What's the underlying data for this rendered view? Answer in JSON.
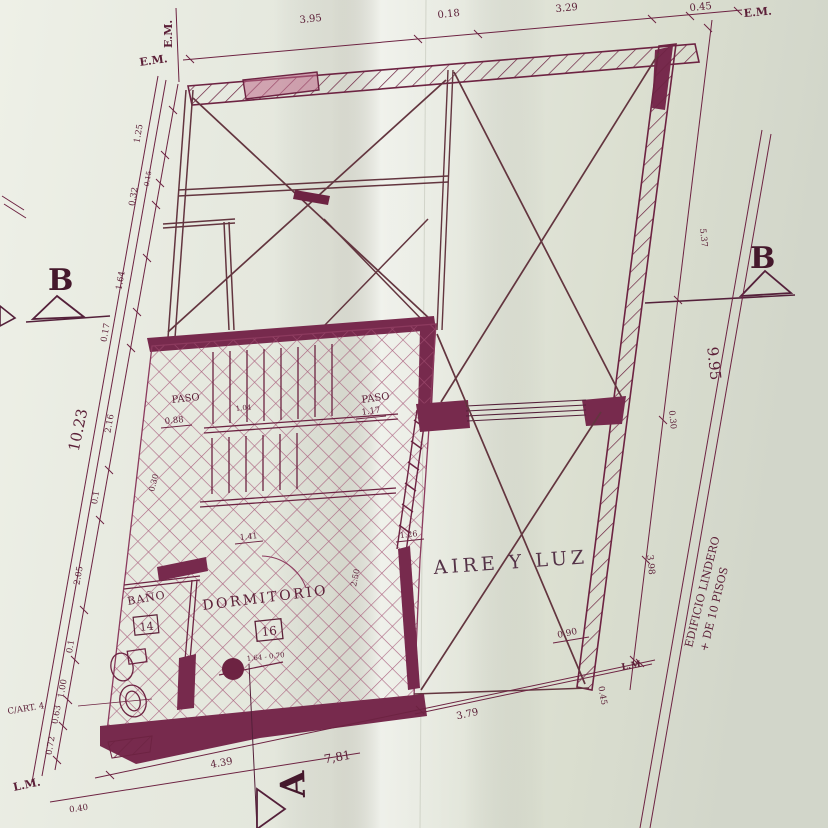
{
  "title": "Planta arquitectónica - plano escaneado",
  "palette": {
    "ink": "#6d2342",
    "ink_dark": "#54203a",
    "ink_light": "#a24f72",
    "wall_fill": "#772a4d",
    "paper": "#e6e9df",
    "paper_dark": "#d7dbd0",
    "text": "#5c2038",
    "accent_pink": "#c06a8a"
  },
  "markers": {
    "section_b_left": "B",
    "section_b_right": "B",
    "section_a": "A"
  },
  "boundary_labels": {
    "em_left_vertical": "E.M.",
    "em_left": "E.M.",
    "em_right": "E.M.",
    "lm_left": "L.M.",
    "lm_right": "L.M",
    "cart": "C/ART. 4",
    "edificio_line1": "EDIFICIO LINDERO",
    "edificio_line2": "+ DE 10 PISOS"
  },
  "rooms": {
    "paso_left": {
      "label": "PASO",
      "dim": "0.88"
    },
    "paso_right": {
      "label": "PASO",
      "dim": "1.17"
    },
    "bano": {
      "label": "BAÑO",
      "number": "14"
    },
    "dormitorio": {
      "label": "DORMITORIO",
      "number": "16",
      "door_dim": "1.64 - 0.70"
    },
    "aire": {
      "label": "AIRE Y LUZ"
    }
  },
  "dims": {
    "top": [
      "3.95",
      "0.18",
      "3.29",
      "0.45"
    ],
    "left": [
      "1.25",
      "0.15",
      "0.32",
      "1.64",
      "0.17",
      "10.23",
      "2.16",
      "0.1",
      "2.05",
      "0.1",
      "1.00",
      "0.63",
      "0.72"
    ],
    "right": [
      "5.37",
      "9.95",
      "0.30",
      "3.98",
      "0.90",
      "0.45"
    ],
    "bottom": [
      "4.39",
      "7,81",
      "3.79",
      "0.40"
    ],
    "interior": [
      "0.30",
      "1.04",
      "1.41",
      "1.26",
      "2.50"
    ]
  }
}
